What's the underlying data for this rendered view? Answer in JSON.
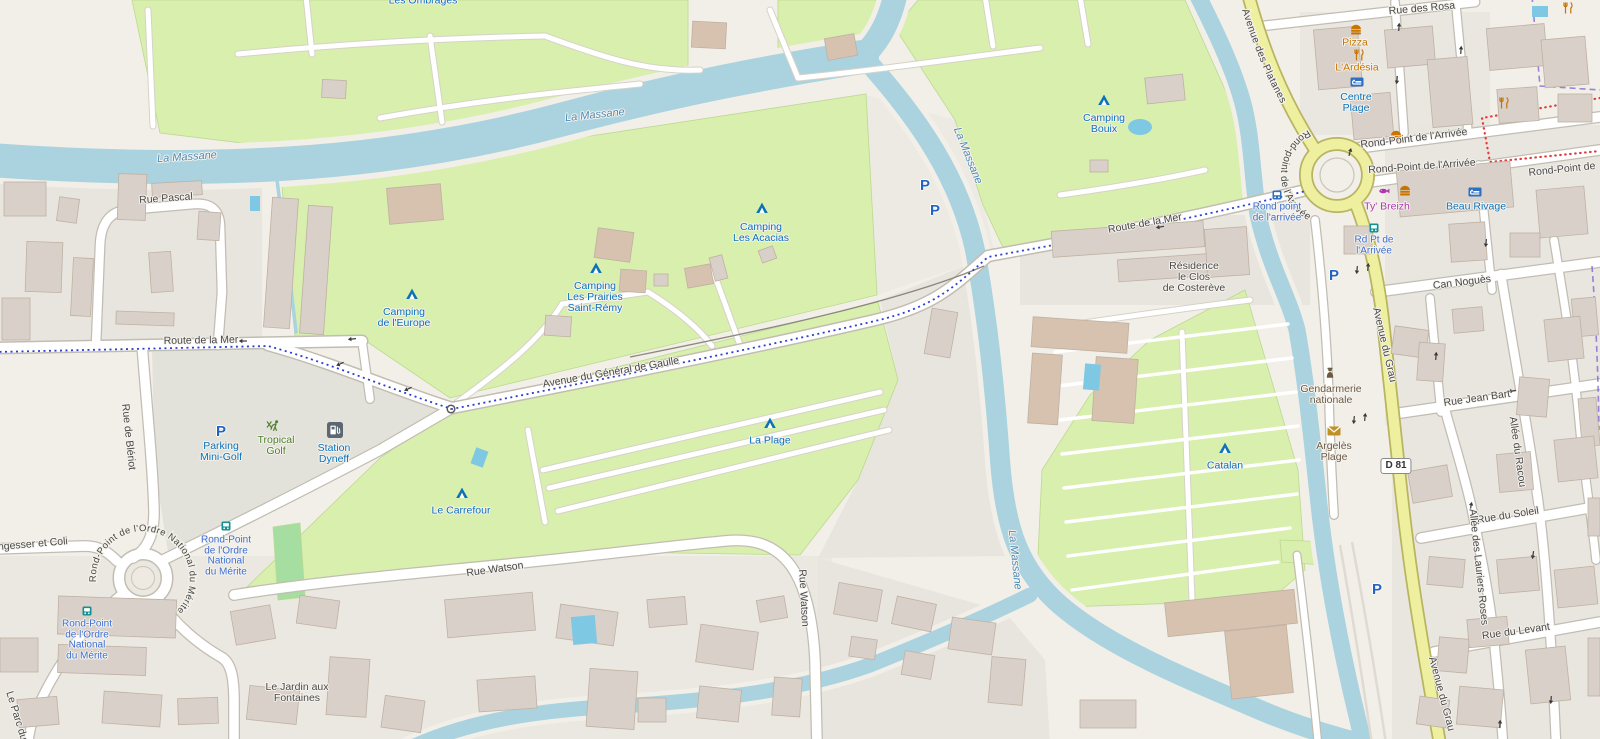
{
  "water": {
    "river_name": "La Massane"
  },
  "streets": {
    "rue_pascal": "Rue Pascal",
    "route_de_la_mer": "Route de la Mer",
    "avenue_general_de_gaulle": "Avenue du Général de Gaulle",
    "rue_watson": "Rue Watson",
    "nungesser_et_coli": "ungesser et Coli",
    "rue_de_bleriot": "Rue de Blériot",
    "le_parc_du": "Le Parc du",
    "rue_des_rosa": "Rue des Rosa",
    "avenue_des_platanes": "Avenue des Platanes",
    "rond_point_arrivee": "Rond-Point de l'Arrivée",
    "rond_point_arrivee_ring": "Rond-point de l'Arrivée",
    "rond_point_de": "Rond-Point de",
    "avenue_du_grau": "Avenue du Grau",
    "can_nogues": "Can Noguès",
    "rue_jean_bart": "Rue Jean Bart",
    "allee_du_racou": "Allée du Racou",
    "rue_du_soleil": "Rue du Soleil",
    "allee_des_lauriers_roses": "Allée des Lauriers Roses",
    "rue_du_levant": "Rue du Levant",
    "rond_point_onm_ring": "Rond-Point de l'Ordre National du Mérite"
  },
  "route_badge": "D 81",
  "parking_symbol": "P",
  "pois": {
    "les_ombrages": "Les Ombrages",
    "camping_bouix": {
      "lines": [
        "Camping",
        "Bouix"
      ]
    },
    "camping_les_acacias": {
      "lines": [
        "Camping",
        "Les Acacias"
      ]
    },
    "camping_les_prairies": {
      "lines": [
        "Camping",
        "Les Prairies",
        "Saint-Rémy"
      ]
    },
    "camping_de_l_europe": {
      "lines": [
        "Camping",
        "de l'Europe"
      ]
    },
    "le_carrefour": "Le Carrefour",
    "la_plage": "La Plage",
    "catalan": "Catalan",
    "pizza": "Pizza",
    "l_ardesia": "L'Ardésia",
    "ty_breizh": "Ty' Breizh",
    "beau_rivage": "Beau Rivage",
    "centre_plage": {
      "lines": [
        "Centre",
        "Plage"
      ]
    },
    "gendarmerie": {
      "lines": [
        "Gendarmerie",
        "nationale"
      ]
    },
    "argeles_plage": {
      "lines": [
        "Argelès",
        "Plage"
      ]
    },
    "parking_mini_golf": {
      "lines": [
        "Parking",
        "Mini-Golf"
      ]
    },
    "tropical_golf": {
      "lines": [
        "Tropical",
        "Golf"
      ]
    },
    "station_dyneff": {
      "lines": [
        "Station",
        "Dyneff"
      ]
    },
    "residence_costereve": {
      "lines": [
        "Résidence",
        "le Clos",
        "de Costerève"
      ]
    },
    "jardin_fontaines": {
      "lines": [
        "Le Jardin aux",
        "Fontaines"
      ]
    }
  },
  "transit_stops": {
    "rond_point_arrivee_stop": {
      "lines": [
        "Rond point",
        "de l'arrivée"
      ]
    },
    "rd_pt_arrivee_stop": {
      "lines": [
        "Rd Pt de",
        "l'Arrivée"
      ]
    },
    "onm_stop": {
      "lines": [
        "Rond-Point",
        "de l'Ordre",
        "National",
        "du Mérite"
      ]
    }
  },
  "colors": {
    "water": "#aad3df",
    "campsite_green": "#d9efad",
    "secondary_road_yellow": "#eef0a0",
    "poi_blue": "#0d72b8",
    "transit_blue": "#3d6fd1",
    "food_orange": "#c77400",
    "seafood_magenta": "#ac39ac",
    "golf_green": "#4c7f2e",
    "amenity_brown": "#6b5b45"
  }
}
